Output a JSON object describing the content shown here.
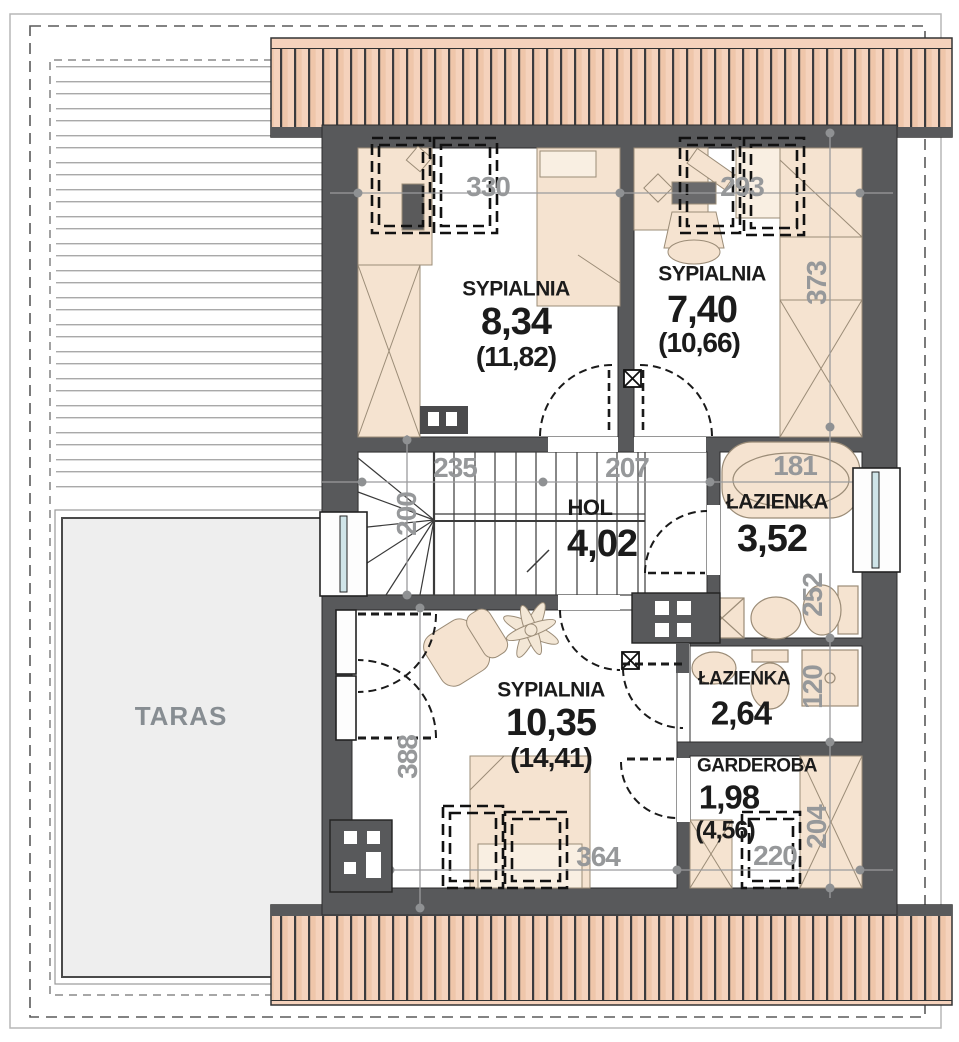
{
  "plan_type": "floor-plan",
  "rooms": [
    {
      "name": "SYPIALNIA",
      "area": "8,34",
      "total": "(11,82)"
    },
    {
      "name": "SYPIALNIA",
      "area": "7,40",
      "total": "(10,66)"
    },
    {
      "name": "HOL",
      "area": "4,02"
    },
    {
      "name": "ŁAZIENKA",
      "area": "3,52"
    },
    {
      "name": "ŁAZIENKA",
      "area": "2,64"
    },
    {
      "name": "GARDEROBA",
      "area": "1,98",
      "total": "(4,56)"
    },
    {
      "name": "SYPIALNIA",
      "area": "10,35",
      "total": "(14,41)"
    },
    {
      "name": "TARAS"
    }
  ],
  "dims": [
    "330",
    "293",
    "373",
    "235",
    "207",
    "181",
    "200",
    "252",
    "120",
    "388",
    "364",
    "220",
    "204"
  ],
  "colors": {
    "wall": "#58595b",
    "eaves_fill": "#f5d2bc",
    "eaves_stripe": "#3b3b3d",
    "furniture": "#f5e3d0",
    "furniture_line": "#9b8c77",
    "glass": "#cfe4e8",
    "dim_text": "#96989a",
    "room_text": "#1b1b1b",
    "taras_fill": "#eeeeee",
    "taras_text": "#878d92"
  },
  "icons": [
    "roof-window-icon",
    "vent-icon",
    "chimney-icon",
    "stairs-icon",
    "bathtub-icon",
    "toilet-icon",
    "sink-icon",
    "shower-icon",
    "washer-icon",
    "bed-icon",
    "wardrobe-icon",
    "armchair-icon",
    "plant-icon",
    "window-icon",
    "door-arc-icon"
  ]
}
